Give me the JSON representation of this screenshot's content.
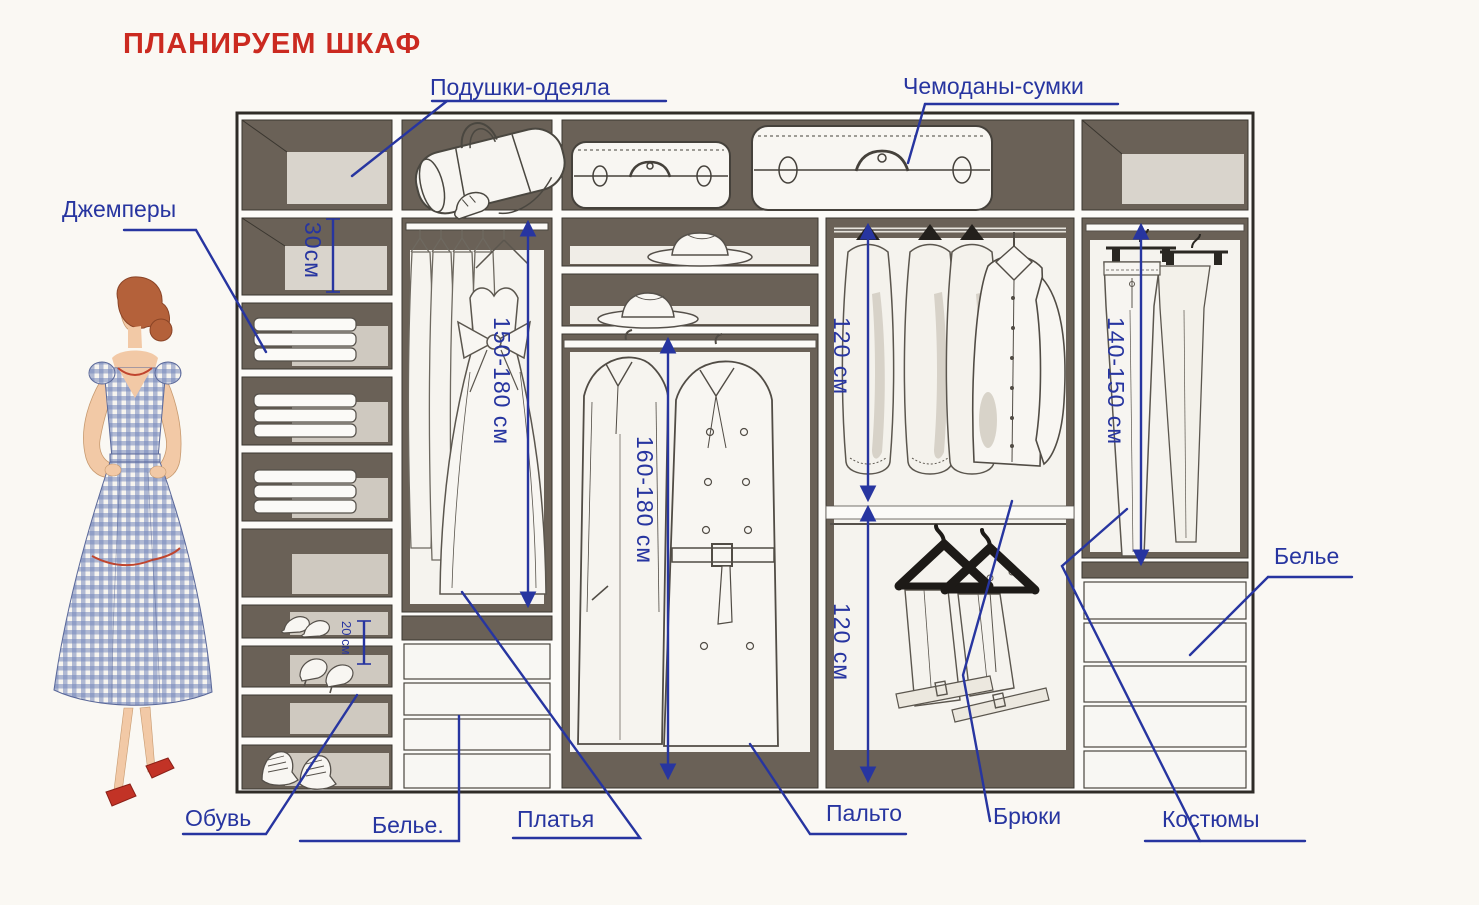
{
  "title": "ПЛАНИРУЕМ ШКАФ",
  "callouts": {
    "pillows": "Подушки-одеяла",
    "suitcases_bags": "Чемоданы-сумки",
    "sweaters": "Джемперы",
    "shoes": "Обувь",
    "linen_drawers_left": "Белье.",
    "dresses": "Платья",
    "coats": "Пальто",
    "trousers": "Брюки",
    "suits": "Костюмы",
    "linen_drawers_right": "Белье"
  },
  "measurements": {
    "sweater_shelf_height": "30см",
    "shoe_shelf_height": "20 см",
    "dress_section_height": "150-180 см",
    "coat_section_height": "160-180 см",
    "shirt_section_height": "120 см",
    "trouser_section_height": "120 см",
    "suit_section_height": "140-150 см"
  },
  "colors": {
    "title_red": "#cb2a20",
    "callout_blue": "#2735a0",
    "cabinet_shadow": "#6a6157",
    "cabinet_back": "#d9d4cc",
    "paper": "#faf8f3",
    "figure_dress_blue": "#7688bb",
    "figure_shoe_red": "#c23326"
  },
  "illustrations": [
    "woman-in-gingham-dress",
    "duffel-bag",
    "suitcase-small",
    "suitcase-large",
    "hanging-dresses",
    "fedora-hats",
    "trench-coats",
    "garment-bags",
    "dress-shirt",
    "draped-trousers-on-hangers",
    "clipped-trousers",
    "folded-knitwear-stacks",
    "shoes-on-shelves",
    "linen-drawers"
  ]
}
